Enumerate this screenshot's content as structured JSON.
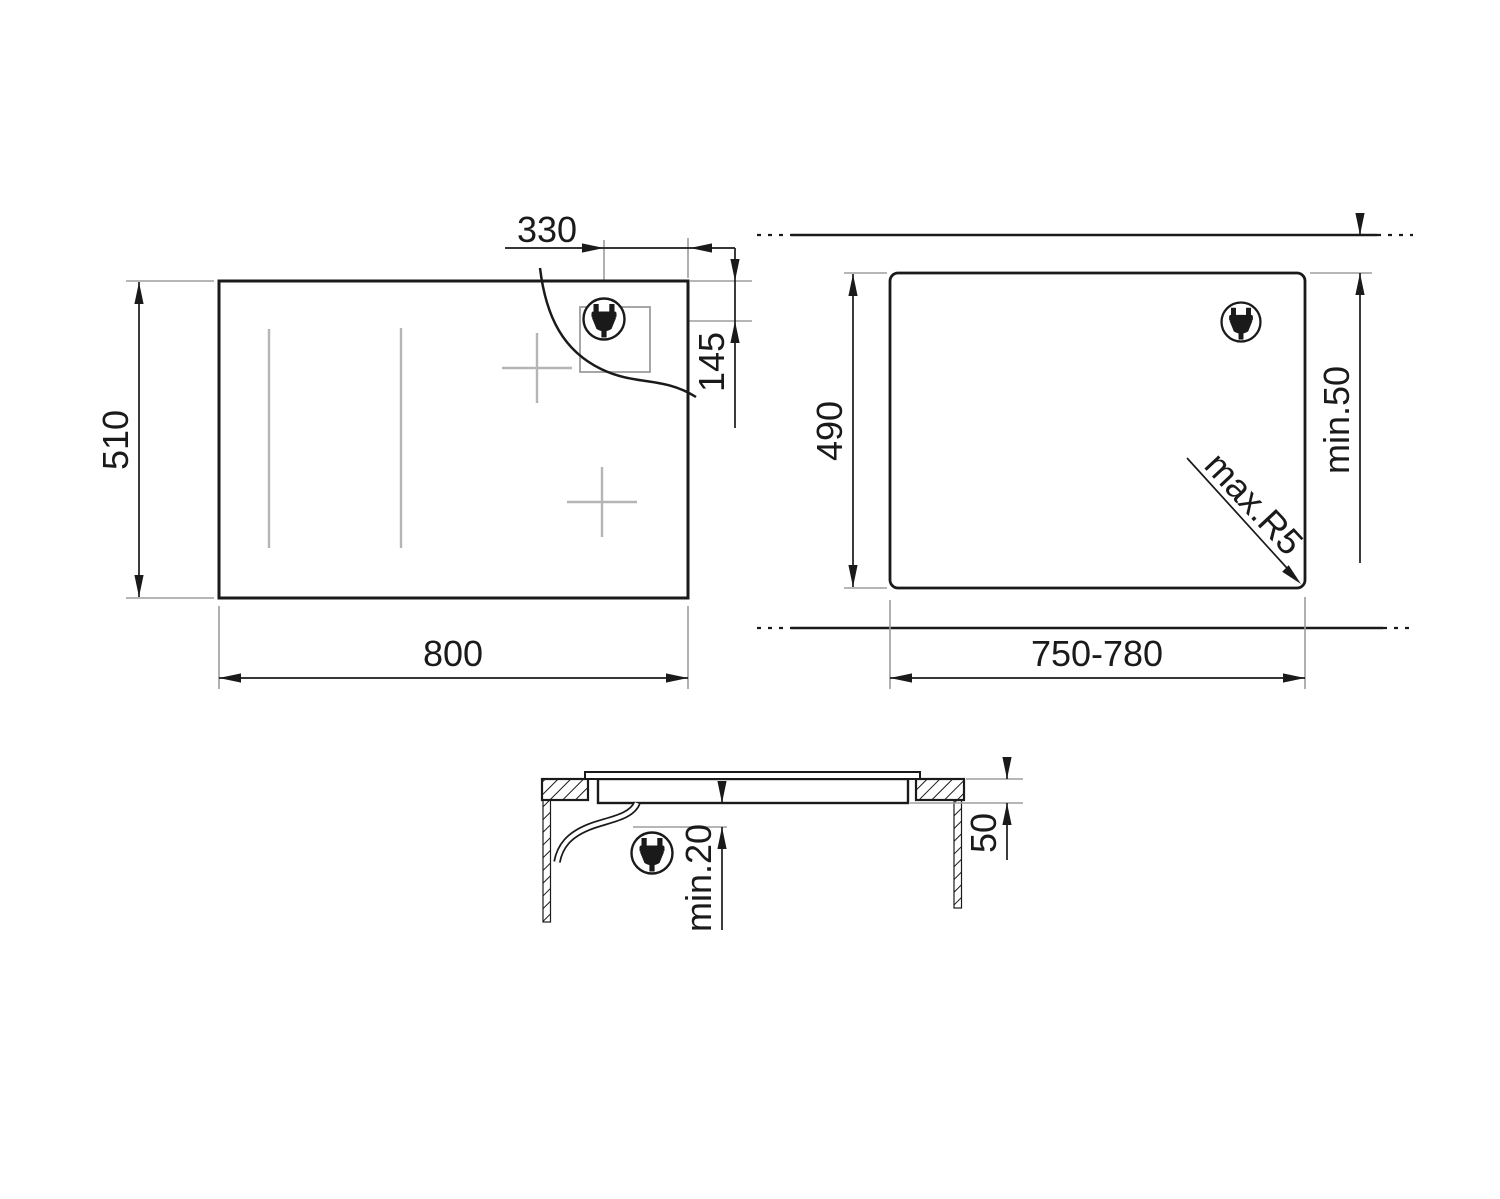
{
  "drawing": {
    "kind": "hob installation dimensions",
    "top_view": {
      "width": "800",
      "height": "510",
      "plug_offset_from_right": "330",
      "plug_offset_from_top": "145"
    },
    "cutout_view": {
      "width_range": "750-780",
      "height": "490",
      "rear_clearance": "min.50",
      "corner_radius": "max.R5"
    },
    "section_view": {
      "below_clearance": "min.20",
      "worktop_thickness": "50"
    },
    "icons": {
      "plug": "power-plug-icon"
    },
    "colors": {
      "line": "#1a1a1a",
      "extension_line": "#9d9d9d",
      "zone_marking": "#b5b5b5",
      "background": "#ffffff"
    }
  }
}
